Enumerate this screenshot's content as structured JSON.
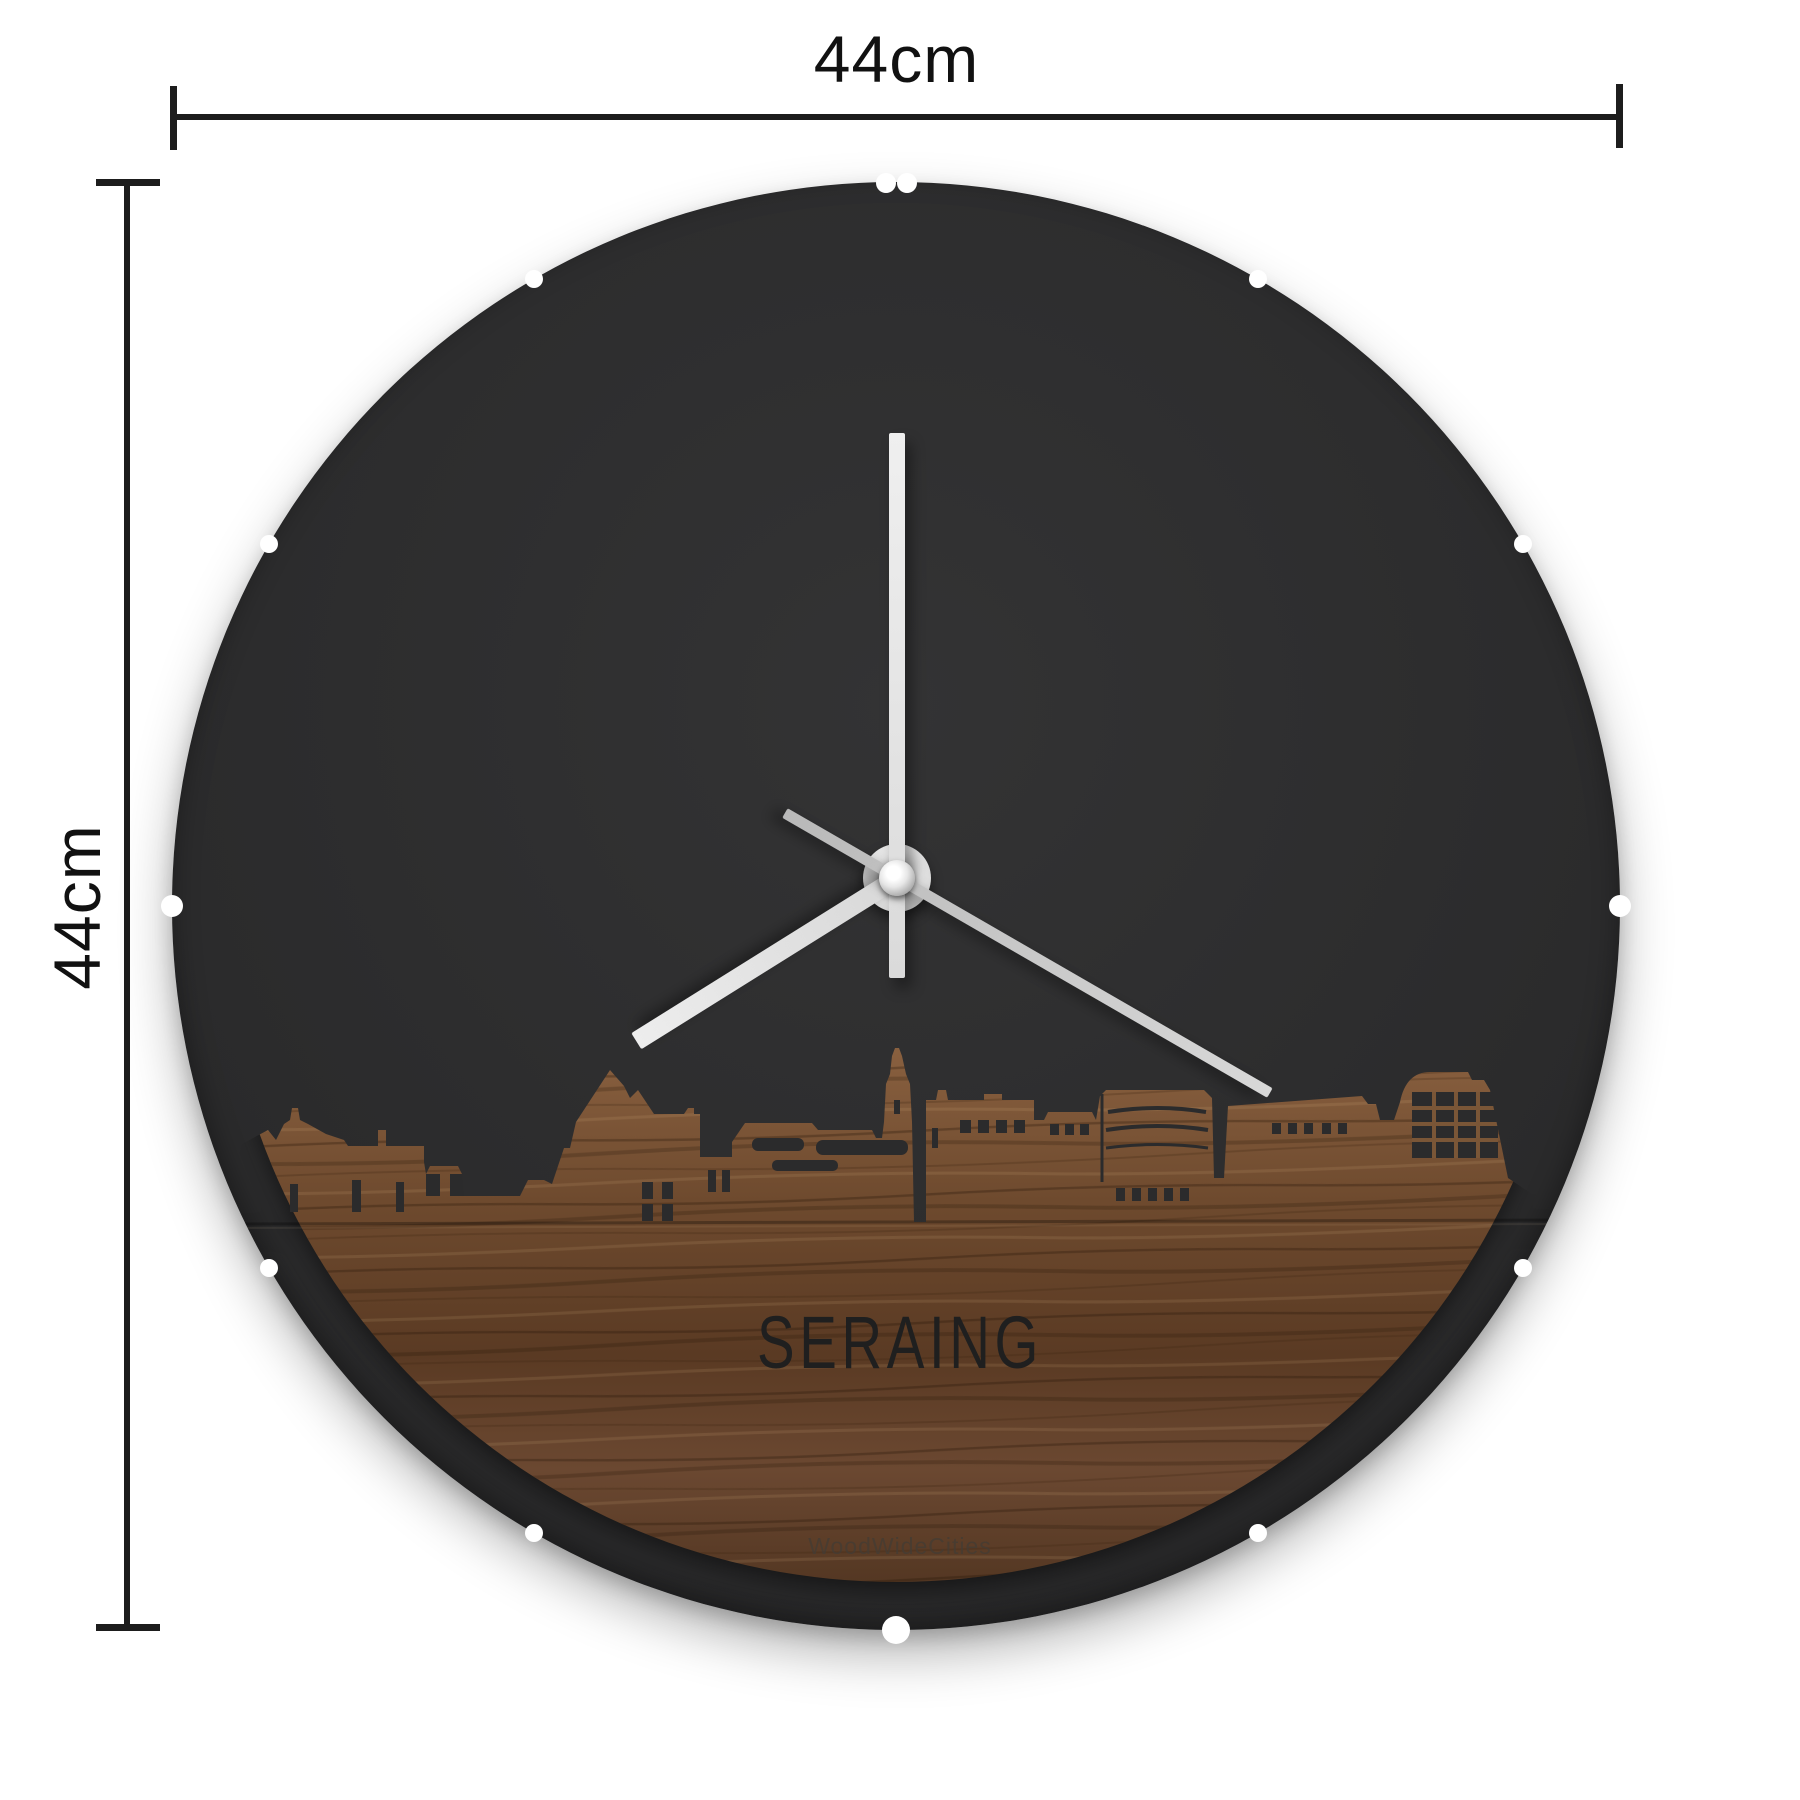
{
  "annotations": {
    "width_label": "44cm",
    "height_label": "44cm"
  },
  "clock": {
    "city_label": "SERAING",
    "watermark": "WoodWideCities",
    "face_color": "#2b2b2c",
    "hand_color": "#e8e8e8",
    "second_hand_color": "#c0c0c0",
    "wood_colors": [
      "#8a6140",
      "#6e4a2e",
      "#5a3a23",
      "#4e331f"
    ],
    "hands": {
      "minute_deg": 0,
      "hour_deg": 238,
      "second_deg": 120
    },
    "notch_hours": [
      1,
      2,
      3,
      4,
      5,
      6,
      7,
      8,
      9,
      10,
      11
    ],
    "notch_double_hour": 12
  },
  "skyline": {
    "path": "M 0 1000 L 58 1000 L 70 962 L 96 948 L 104 958 L 112 942 L 118 938 L 120 926 L 126 926 L 128 938 L 136 942 L 154 952 L 172 958 L 176 964 L 206 964 L 206 948 L 214 948 L 214 964 L 252 964 L 252 980 L 254 992 L 258 984 L 286 984 L 290 992 L 292 1014 L 348 1014 L 356 998 L 372 998 L 380 1002 L 392 966 L 398 966 L 404 940 L 438 888 L 452 904 L 458 916 L 466 908 L 482 932 L 512 932 L 516 926 L 522 926 L 522 932 L 528 932 L 528 975 L 560 975 L 560 960 L 573 941 L 640 941 L 646 948 L 700 948 L 704 956 L 710 956 L 712 940 L 714 902 L 718 892 L 720 874 L 723 866 L 727 866 L 730 874 L 734 892 L 738 902 L 740 940 L 742 1040 L 754 1040 L 754 918 L 764 918 L 766 908 L 774 908 L 776 918 L 812 918 L 812 912 L 830 912 L 830 918 L 862 918 L 862 938 L 872 938 L 876 930 L 920 930 L 924 938 L 928 914 L 934 908 L 1032 908 L 1040 916 L 1042 996 L 1052 996 L 1056 924 L 1190 914 L 1196 922 L 1204 922 L 1208 938 L 1222 938 L 1228 920 Q 1234 890 1258 890 L 1296 890 L 1300 898 L 1312 898 L 1318 908 L 1336 996 L 1360 1012 L 1448 1012 L 1448 1448 L 0 1448 Z"
  }
}
